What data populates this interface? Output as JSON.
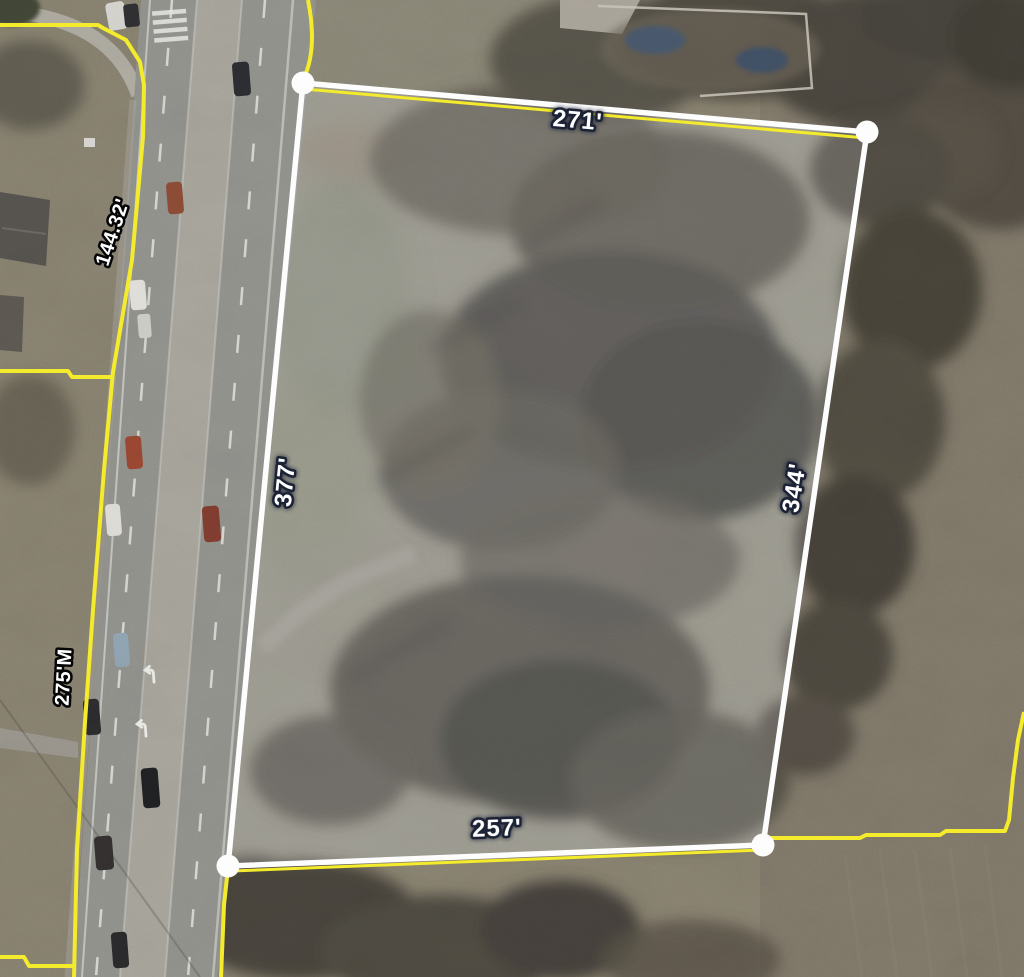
{
  "map": {
    "description": "Aerial parcel map with distance measurement overlay",
    "colors": {
      "parcel_boundary_yellow": "#f3eb2c",
      "measurement_white": "#fdfdfd",
      "measurement_fill": "rgba(228,231,240,0.16)",
      "dimension_halo": "#1c2434",
      "frontage_halo": "#060606"
    }
  },
  "measurement": {
    "sides": [
      {
        "position": "top",
        "label": "271'"
      },
      {
        "position": "right",
        "label": "344'"
      },
      {
        "position": "bottom",
        "label": "257'"
      },
      {
        "position": "left",
        "label": "377'"
      }
    ]
  },
  "frontage_labels": [
    {
      "position": "north",
      "text": "144.32'"
    },
    {
      "position": "south",
      "text": "275'M"
    }
  ]
}
